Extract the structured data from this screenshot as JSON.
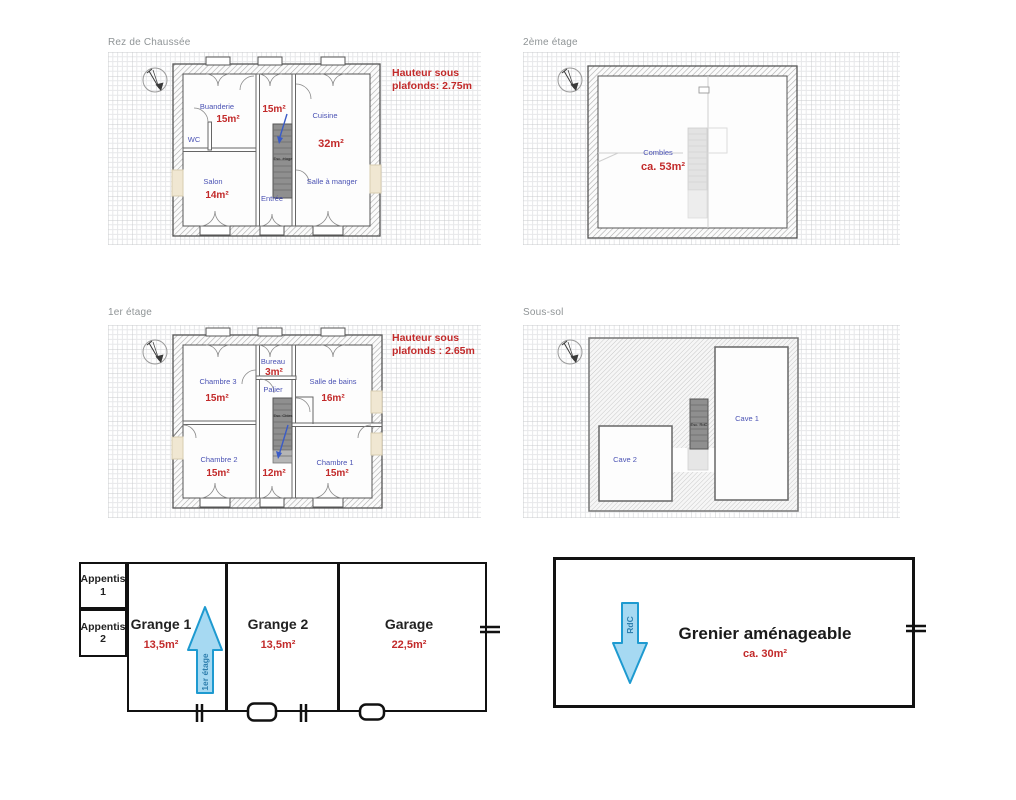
{
  "plans": {
    "rdc": {
      "title": "Rez de Chaussée",
      "note1": "Hauteur sous",
      "note2": "plafonds: 2.75m",
      "stairs_label": "Esc. étage",
      "rooms": {
        "buanderie": {
          "name": "Buanderie",
          "area": "15m²"
        },
        "wc": {
          "name": "WC"
        },
        "hall": {
          "area": "15m²"
        },
        "cuisine": {
          "name": "Cuisine",
          "area": "32m²"
        },
        "salon": {
          "name": "Salon",
          "area": "14m²"
        },
        "salle_a_manger": {
          "name": "Salle à manger"
        },
        "entree": {
          "name": "Entrée"
        }
      }
    },
    "etage2": {
      "title": "2ème étage",
      "rooms": {
        "combles": {
          "name": "Combles",
          "area": "ca. 53m²"
        }
      }
    },
    "etage1": {
      "title": "1er étage",
      "note1": "Hauteur sous",
      "note2": "plafonds : 2.65m",
      "stairs_label": "Esc. Cbles",
      "rooms": {
        "bureau": {
          "name": "Bureau",
          "area": "3m²"
        },
        "chambre3": {
          "name": "Chambre 3",
          "area": "15m²"
        },
        "palier": {
          "name": "Palier",
          "area": "12m²"
        },
        "sdb": {
          "name": "Salle de bains",
          "area": "16m²"
        },
        "chambre2": {
          "name": "Chambre 2",
          "area": "15m²"
        },
        "chambre1": {
          "name": "Chambre 1",
          "area": "15m²"
        }
      }
    },
    "soussol": {
      "title": "Sous-sol",
      "stairs_label": "Esc. RdC",
      "rooms": {
        "cave1": {
          "name": "Cave 1"
        },
        "cave2": {
          "name": "Cave 2"
        }
      }
    }
  },
  "outbuildings": {
    "appentis1": "Appentis 1",
    "appentis2": "Appentis 2",
    "grange1": {
      "name": "Grange 1",
      "area": "13,5m²"
    },
    "grange2": {
      "name": "Grange 2",
      "area": "13,5m²"
    },
    "garage": {
      "name": "Garage",
      "area": "22,5m²"
    },
    "arrow_label": "1er étage"
  },
  "grenier": {
    "name": "Grenier aménageable",
    "area": "ca. 30m²",
    "arrow_label": "RdC"
  },
  "colors": {
    "room_label_blue": "#4a52b4",
    "area_red": "#c22a2a",
    "arrow_blue_fill": "#a6d9f2",
    "arrow_blue_stroke": "#1e9ad0"
  }
}
